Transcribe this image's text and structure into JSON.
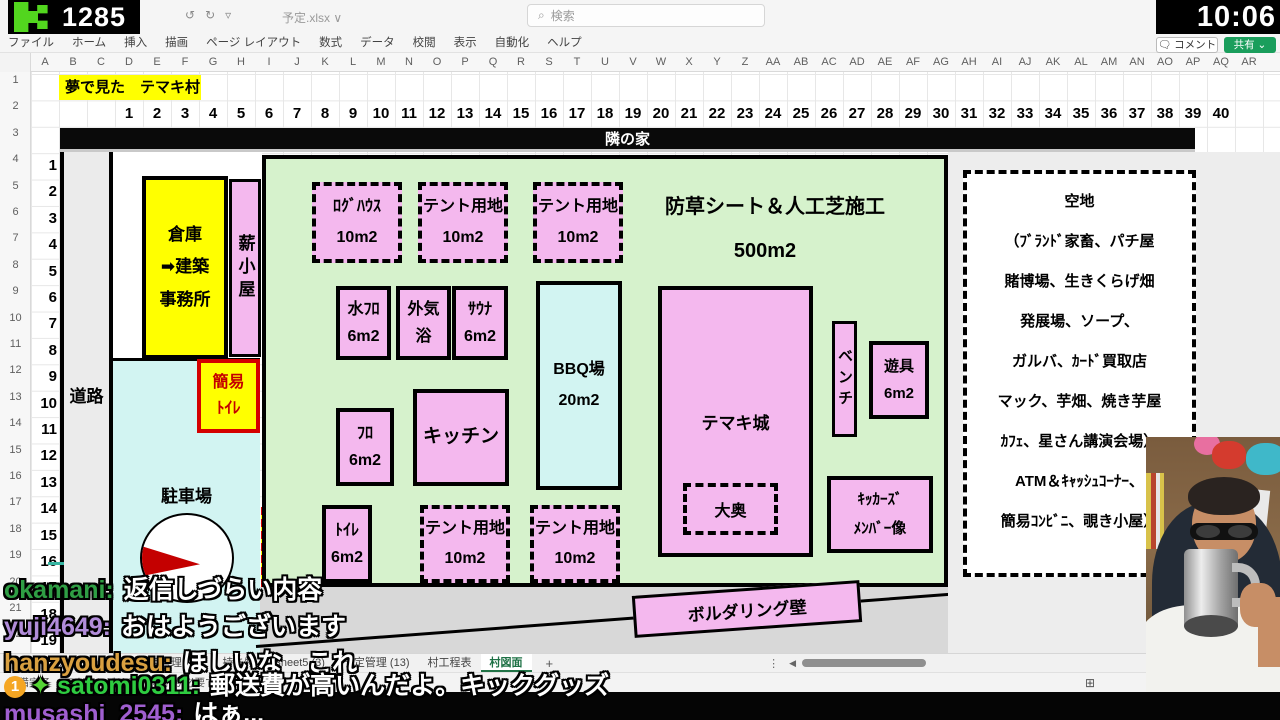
{
  "overlay": {
    "viewer_count": "1285",
    "clock": "10:06",
    "accent_green": "#52d61e"
  },
  "excel": {
    "filename": "予定.xlsx",
    "search_placeholder": "検索",
    "comment_label": "コメント",
    "share_label": "共有",
    "ribbon_tabs": [
      "ファイル",
      "ホーム",
      "挿入",
      "描画",
      "ページ レイアウト",
      "数式",
      "データ",
      "校閲",
      "表示",
      "自動化",
      "ヘルプ"
    ],
    "column_letters": [
      "A",
      "B",
      "C",
      "D",
      "E",
      "F",
      "G",
      "H",
      "I",
      "J",
      "K",
      "L",
      "M",
      "N",
      "O",
      "P",
      "Q",
      "R",
      "S",
      "T",
      "U",
      "V",
      "W",
      "X",
      "Y",
      "Z",
      "AA",
      "AB",
      "AC",
      "AD",
      "AE",
      "AF",
      "AG",
      "AH",
      "AI",
      "AJ",
      "AK",
      "AL",
      "AM",
      "AN",
      "AO",
      "AP",
      "AQ",
      "AR"
    ],
    "row_headers": [
      "1",
      "2",
      "3",
      "4",
      "5",
      "6",
      "7",
      "8",
      "9",
      "10",
      "11",
      "12",
      "13",
      "14",
      "15",
      "16",
      "17",
      "18",
      "19",
      "20",
      "21",
      "22",
      "23"
    ],
    "title_cell": "夢で見た　テマキ村",
    "grid_numbers_top": [
      "1",
      "2",
      "3",
      "4",
      "5",
      "6",
      "7",
      "8",
      "9",
      "10",
      "11",
      "12",
      "13",
      "14",
      "15",
      "16",
      "17",
      "18",
      "19",
      "20",
      "21",
      "22",
      "23",
      "24",
      "25",
      "26",
      "27",
      "28",
      "29",
      "30",
      "31",
      "32",
      "33",
      "34",
      "35",
      "36",
      "37",
      "38",
      "39",
      "40"
    ],
    "grid_numbers_left": [
      "1",
      "2",
      "3",
      "4",
      "5",
      "6",
      "7",
      "8",
      "9",
      "10",
      "11",
      "12",
      "13",
      "14",
      "15",
      "16",
      "17",
      "18",
      "19",
      "20"
    ],
    "sheet_tabs": {
      "more": "…",
      "items": [
        "Sheet4",
        "予定管理 (26)",
        "持ち物",
        "Sheet5 (3)",
        "予定管理 (13)",
        "村工程表",
        "村図面"
      ],
      "active_index": 6,
      "add": "+",
      "dots": "⋮",
      "arrow": "◀"
    },
    "status": {
      "ready": "準備完了",
      "accessibility": "アクセシビリティ: 検討が必要です"
    }
  },
  "map": {
    "neighbor": "隣の家",
    "road": "道路",
    "green_title": "防草シート＆人工芝施工",
    "green_size": "500m2",
    "plots": {
      "warehouse": {
        "l1": "倉庫",
        "l2": "➡建築",
        "l3": "事務所"
      },
      "firewood": {
        "l1": "薪小屋"
      },
      "simple_toilet": {
        "l1": "簡易",
        "l2": "ﾄｲﾚ"
      },
      "parking": {
        "l1": "駐車場"
      },
      "septic": {
        "l1": "浄化",
        "l2": "槽"
      },
      "loghouse": {
        "l1": "ﾛｸﾞﾊｳｽ",
        "l2": "10m2"
      },
      "tent1": {
        "l1": "テント用地",
        "l2": "10m2"
      },
      "tent2": {
        "l1": "テント用地",
        "l2": "10m2"
      },
      "mizuburo": {
        "l1": "水ﾌﾛ",
        "l2": "6m2"
      },
      "gaikiyoku": {
        "l1": "外気",
        "l2": "浴"
      },
      "sauna": {
        "l1": "ｻｳﾅ",
        "l2": "6m2"
      },
      "bbq": {
        "l1": "BBQ場",
        "l2": "20m2"
      },
      "furo": {
        "l1": "ﾌﾛ",
        "l2": "6m2"
      },
      "kitchen": {
        "l1": "キッチン"
      },
      "castle": {
        "l1": "テマキ城"
      },
      "oooku": {
        "l1": "大奥"
      },
      "bench": {
        "l1": "ベンチ"
      },
      "playground": {
        "l1": "遊具",
        "l2": "6m2"
      },
      "kickers": {
        "l1": "ｷｯｶｰｽﾞ",
        "l2": "ﾒﾝﾊﾞｰ像"
      },
      "toilet": {
        "l1": "ﾄｲﾚ",
        "l2": "6m2"
      },
      "tent3": {
        "l1": "テント用地",
        "l2": "10m2"
      },
      "tent4": {
        "l1": "テント用地",
        "l2": "10m2"
      },
      "bouldering": {
        "l1": "ボルダリング壁"
      }
    },
    "vacant": {
      "title": "空地",
      "lines": [
        "（ﾌﾞﾗﾝﾄﾞ家畜、パチ屋",
        "賭博場、生きくらげ畑",
        "発展場、ソープ、",
        "ガルバ、ｶｰﾄﾞ買取店",
        "マック、芋畑、焼き芋屋",
        "ｶﾌｪ、星さん講演会場）",
        "ATM＆ｷｬｯｼｭｺｰﾅｰ、",
        "簡易ｺﾝﾋﾞﾆ、覗き小屋）"
      ]
    }
  },
  "chat": {
    "messages": [
      {
        "user": "okamani:",
        "color": "#2f9e44",
        "text": "返信しづらい内容",
        "badges": [],
        "top": 570
      },
      {
        "user": "yuji4649:",
        "color": "#b18cd9",
        "text": "おはようございます",
        "badges": [],
        "top": 607
      },
      {
        "user": "hanzyoudesu:",
        "color": "#d9a040",
        "text": "ほしいな　これ",
        "badges": [],
        "top": 643
      },
      {
        "user": "satomi0311:",
        "color": "#2ecc40",
        "text": "郵送費が高いんだよ。キックグッズ",
        "badges": [
          "1",
          "✦"
        ],
        "top": 666
      },
      {
        "user": "musashi_2545:",
        "color": "#a05fd0",
        "text": "はぁ...",
        "badges": [],
        "top": 694
      }
    ]
  }
}
